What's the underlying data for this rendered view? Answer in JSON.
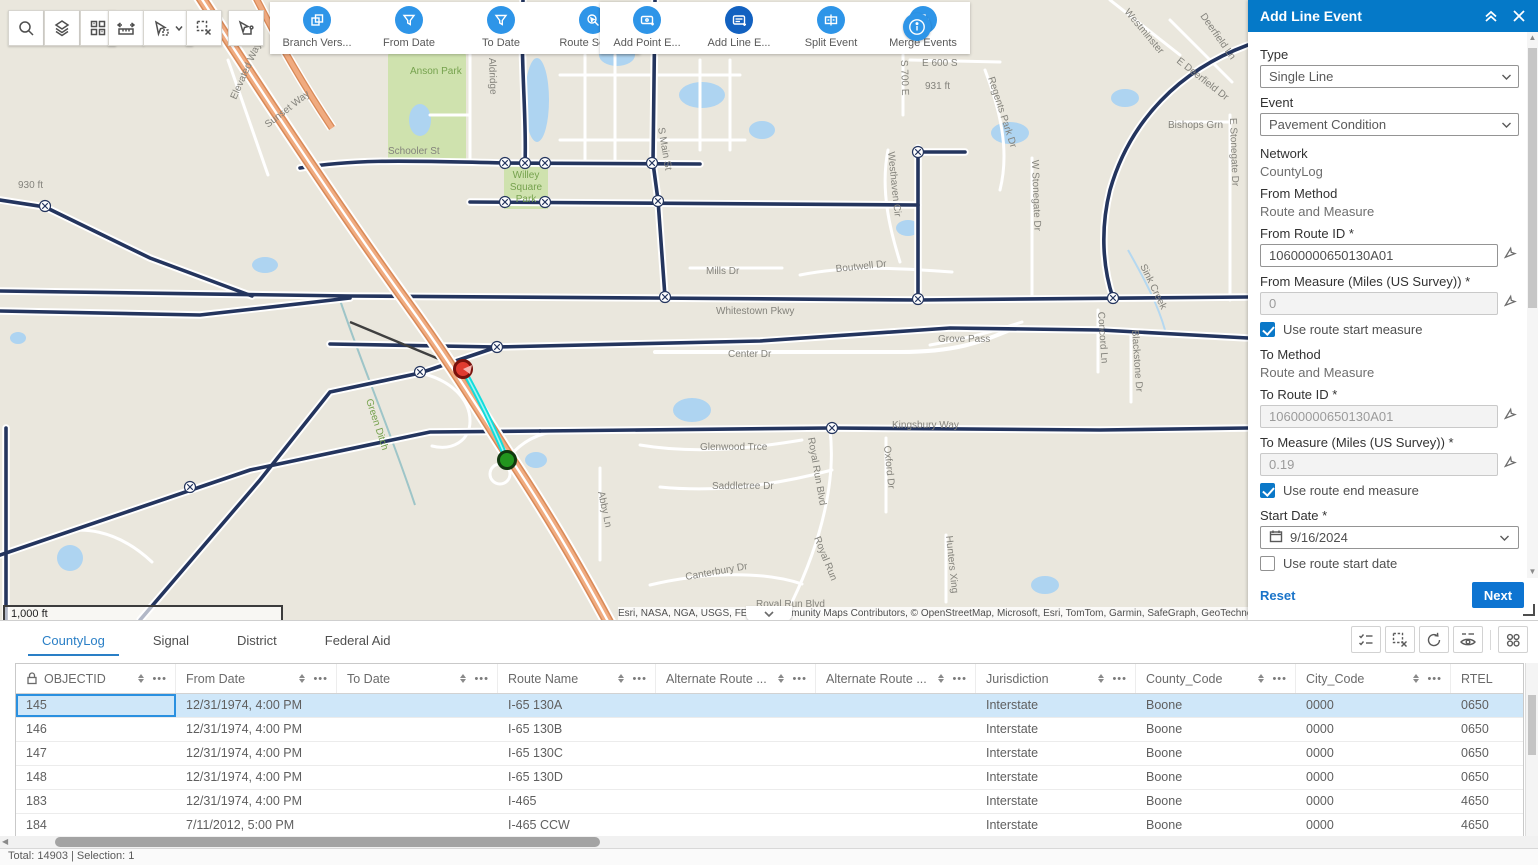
{
  "colors": {
    "accent_blue": "#0a78c8",
    "panel_header_blue": "#0579c8",
    "toolbar_circle_blue": "#2e95e8",
    "active_tool_blue": "#1261c0",
    "selection_cyan": "#12dcdc",
    "selected_row_blue": "#cfe7f9",
    "highway_orange": "#f0ab80",
    "road_navy": "#24355e",
    "water_blue": "#aed4f1",
    "park_green": "#cfe2ae"
  },
  "toolbar": {
    "map_tools": [
      {
        "name": "search",
        "icon": "magnifier-icon"
      },
      {
        "name": "layers",
        "icon": "layers-icon"
      },
      {
        "name": "basemap",
        "icon": "basemap-grid-icon"
      },
      {
        "name": "measure",
        "icon": "measure-icon"
      },
      {
        "name": "select",
        "icon": "select-pointer-icon"
      },
      {
        "name": "clear-selection",
        "icon": "clear-selection-icon"
      },
      {
        "name": "route-tool",
        "icon": "route-pointer-icon"
      }
    ],
    "group1": {
      "buttons": [
        {
          "label": "Branch Vers...",
          "icon": "branch-versions-icon",
          "active": false
        },
        {
          "label": "From Date",
          "icon": "filter-icon",
          "active": false
        },
        {
          "label": "To Date",
          "icon": "filter-icon",
          "active": false
        },
        {
          "label": "Route Search",
          "icon": "route-search-icon",
          "active": false
        }
      ]
    },
    "group2": {
      "buttons": [
        {
          "label": "Add Point E...",
          "icon": "add-point-event-icon",
          "active": false
        },
        {
          "label": "Add Line E...",
          "icon": "add-line-event-icon",
          "active": true
        },
        {
          "label": "Split Event",
          "icon": "split-event-icon",
          "active": false
        },
        {
          "label": "Merge Events",
          "icon": "merge-events-icon",
          "active": false
        }
      ]
    },
    "info_button_icon": "info-icon"
  },
  "map": {
    "scale_label": "1,000 ft",
    "attribution": "Esri, NASA, NGA, USGS, FEMA | Community Maps Contributors, © OpenStreetMap, Microsoft, Esri, TomTom, Garmin, SafeGraph, GeoTechnol",
    "labels": [
      {
        "t": "Elevated Way",
        "x": 236,
        "y": 100,
        "r": -66
      },
      {
        "t": "Sunset Way",
        "x": 268,
        "y": 128,
        "r": -38
      },
      {
        "t": "Anson Park",
        "x": 410,
        "y": 74,
        "c": "green"
      },
      {
        "t": "Aldridge",
        "x": 489,
        "y": 58,
        "r": 88
      },
      {
        "t": "Willey",
        "x": 526,
        "y": 178,
        "c": "green",
        "a": "middle"
      },
      {
        "t": "Square",
        "x": 526,
        "y": 190,
        "c": "green",
        "a": "middle"
      },
      {
        "t": "Park",
        "x": 526,
        "y": 202,
        "c": "green",
        "a": "middle"
      },
      {
        "t": "Schooler St",
        "x": 388,
        "y": 154
      },
      {
        "t": "S Main St",
        "x": 658,
        "y": 128,
        "r": 80
      },
      {
        "t": "E 600 S",
        "x": 922,
        "y": 66
      },
      {
        "t": "931 ft",
        "x": 925,
        "y": 89
      },
      {
        "t": "930 ft",
        "x": 18,
        "y": 188
      },
      {
        "t": "S 700 E",
        "x": 901,
        "y": 60,
        "r": 88
      },
      {
        "t": "Regents Park Dr",
        "x": 988,
        "y": 78,
        "r": 72
      },
      {
        "t": "Westminster",
        "x": 1124,
        "y": 12,
        "r": 50
      },
      {
        "t": "Deerfield Ln",
        "x": 1200,
        "y": 16,
        "r": 55
      },
      {
        "t": "E Deerfield Dr",
        "x": 1176,
        "y": 62,
        "r": 38
      },
      {
        "t": "Bishops Grn",
        "x": 1168,
        "y": 128
      },
      {
        "t": "E Stonegate Dr",
        "x": 1230,
        "y": 118,
        "r": 88
      },
      {
        "t": "Westhaven Cir",
        "x": 888,
        "y": 152,
        "r": 84
      },
      {
        "t": "W Stonegate Dr",
        "x": 1032,
        "y": 160,
        "r": 88
      },
      {
        "t": "Mills Dr",
        "x": 706,
        "y": 274
      },
      {
        "t": "Boutwell Dr",
        "x": 836,
        "y": 272,
        "r": -6
      },
      {
        "t": "Sink Creek",
        "x": 1140,
        "y": 266,
        "r": 64
      },
      {
        "t": "Whitestown Pkwy",
        "x": 716,
        "y": 314
      },
      {
        "t": "Center Dr",
        "x": 728,
        "y": 357
      },
      {
        "t": "Grove Pass",
        "x": 938,
        "y": 342
      },
      {
        "t": "Concord Ln",
        "x": 1098,
        "y": 312,
        "r": 86
      },
      {
        "t": "Blackstone Dr",
        "x": 1132,
        "y": 330,
        "r": 86
      },
      {
        "t": "Kingsbury Way",
        "x": 892,
        "y": 428
      },
      {
        "t": "Glenwood Trce",
        "x": 700,
        "y": 450
      },
      {
        "t": "Royal Run Blvd",
        "x": 808,
        "y": 438,
        "r": 80
      },
      {
        "t": "Oxford Dr",
        "x": 884,
        "y": 446,
        "r": 84
      },
      {
        "t": "Saddletree Dr",
        "x": 712,
        "y": 489
      },
      {
        "t": "Abby Ln",
        "x": 598,
        "y": 492,
        "r": 78
      },
      {
        "t": "Royal Run",
        "x": 814,
        "y": 538,
        "r": 68
      },
      {
        "t": "Canterbury Dr",
        "x": 686,
        "y": 580,
        "r": -10
      },
      {
        "t": "Hunters Xing",
        "x": 946,
        "y": 536,
        "r": 84
      },
      {
        "t": "Royal Run Blvd",
        "x": 756,
        "y": 607
      },
      {
        "t": "Green Ditch",
        "x": 366,
        "y": 400,
        "r": 72,
        "c": "green"
      }
    ]
  },
  "panel": {
    "title": "Add Line Event",
    "type_label": "Type",
    "type_value": "Single Line",
    "event_label": "Event",
    "event_value": "Pavement Condition",
    "network_label": "Network",
    "network_value": "CountyLog",
    "from_method_label": "From Method",
    "from_method_value": "Route and Measure",
    "from_route_label": "From Route ID *",
    "from_route_value": "10600000650130A01",
    "from_measure_label": "From Measure (Miles (US Survey)) *",
    "from_measure_value": "0",
    "use_route_start_measure": {
      "label": "Use route start measure",
      "checked": true
    },
    "to_method_label": "To Method",
    "to_method_value": "Route and Measure",
    "to_route_label": "To Route ID *",
    "to_route_value": "10600000650130A01",
    "to_measure_label": "To Measure (Miles (US Survey)) *",
    "to_measure_value": "0.19",
    "use_route_end_measure": {
      "label": "Use route end measure",
      "checked": true
    },
    "start_date_label": "Start Date *",
    "start_date_value": "9/16/2024",
    "use_route_start_date": {
      "label": "Use route start date",
      "checked": false
    },
    "end_date_label": "End Date",
    "end_date_placeholder": "MM/DD/YYYY",
    "use_route_end_date": {
      "label": "Use route end date",
      "checked": false
    },
    "reset_label": "Reset",
    "next_label": "Next"
  },
  "table": {
    "tabs": [
      {
        "label": "CountyLog",
        "active": true
      },
      {
        "label": "Signal",
        "active": false
      },
      {
        "label": "District",
        "active": false
      },
      {
        "label": "Federal Aid",
        "active": false
      }
    ],
    "columns": [
      "OBJECTID",
      "From Date",
      "To Date",
      "Route Name",
      "Alternate Route ...",
      "Alternate Route ...",
      "Jurisdiction",
      "County_Code",
      "City_Code",
      "RTEL"
    ],
    "rows": [
      {
        "selected": true,
        "cells": [
          "145",
          "12/31/1974, 4:00 PM",
          "",
          "I-65 130A",
          "",
          "",
          "Interstate",
          "Boone",
          "0000",
          "0650"
        ]
      },
      {
        "selected": false,
        "cells": [
          "146",
          "12/31/1974, 4:00 PM",
          "",
          "I-65 130B",
          "",
          "",
          "Interstate",
          "Boone",
          "0000",
          "0650"
        ]
      },
      {
        "selected": false,
        "cells": [
          "147",
          "12/31/1974, 4:00 PM",
          "",
          "I-65 130C",
          "",
          "",
          "Interstate",
          "Boone",
          "0000",
          "0650"
        ]
      },
      {
        "selected": false,
        "cells": [
          "148",
          "12/31/1974, 4:00 PM",
          "",
          "I-65 130D",
          "",
          "",
          "Interstate",
          "Boone",
          "0000",
          "0650"
        ]
      },
      {
        "selected": false,
        "cells": [
          "183",
          "12/31/1974, 4:00 PM",
          "",
          "I-465",
          "",
          "",
          "Interstate",
          "Boone",
          "0000",
          "4650"
        ]
      },
      {
        "selected": false,
        "cells": [
          "184",
          "7/11/2012, 5:00 PM",
          "",
          "I-465 CCW",
          "",
          "",
          "Interstate",
          "Boone",
          "0000",
          "4650"
        ]
      }
    ],
    "status": "Total: 14903 | Selection: 1"
  }
}
